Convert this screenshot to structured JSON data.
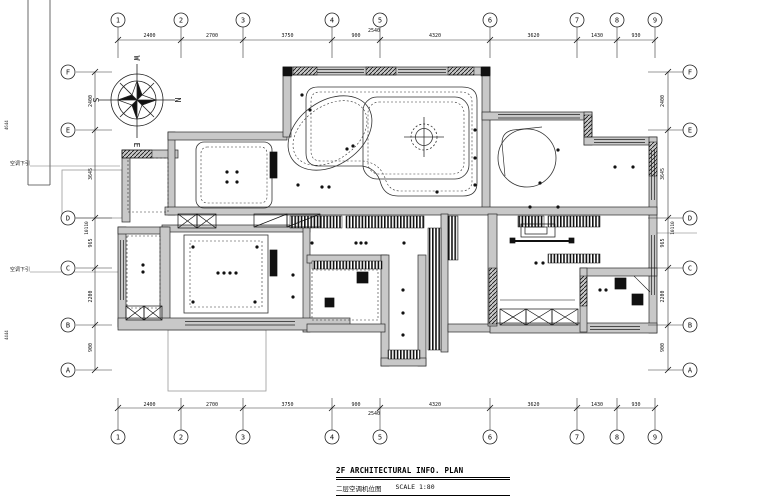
{
  "title_block": {
    "title_en": "2F ARCHITECTURAL INFO. PLAN",
    "title_cn": "二层空调机位图",
    "scale_label": "SCALE 1:80"
  },
  "grid": {
    "top_labels": [
      "1",
      "2",
      "3",
      "4",
      "5",
      "6",
      "7",
      "8",
      "9"
    ],
    "bottom_labels": [
      "1",
      "2",
      "3",
      "4",
      "5",
      "6",
      "7",
      "8",
      "9"
    ],
    "left_labels": [
      "F",
      "E",
      "D",
      "C",
      "B",
      "A"
    ],
    "right_labels": [
      "F",
      "E",
      "D",
      "C",
      "B",
      "A"
    ]
  },
  "dimensions": {
    "top": [
      "2400",
      "2700",
      "3750",
      "900",
      "4320",
      "3620",
      "1430",
      "930"
    ],
    "top_extra": "2540",
    "bottom": [
      "2400",
      "2700",
      "3750",
      "900",
      "4320",
      "3620",
      "1430",
      "930"
    ],
    "bottom_extra": "2540",
    "left": [
      "2400",
      "3645",
      "965",
      "2200",
      "900"
    ],
    "left_total": "10110",
    "right": [
      "2400",
      "3645",
      "965",
      "2200",
      "900"
    ],
    "right_total": "10110"
  },
  "compass": {
    "north": "N",
    "south": "S",
    "east": "E",
    "west": "W"
  },
  "annotations": {
    "left_notes": [
      "空调下引",
      "空调下引"
    ],
    "frame_labels": [
      "4644",
      "4444"
    ]
  }
}
